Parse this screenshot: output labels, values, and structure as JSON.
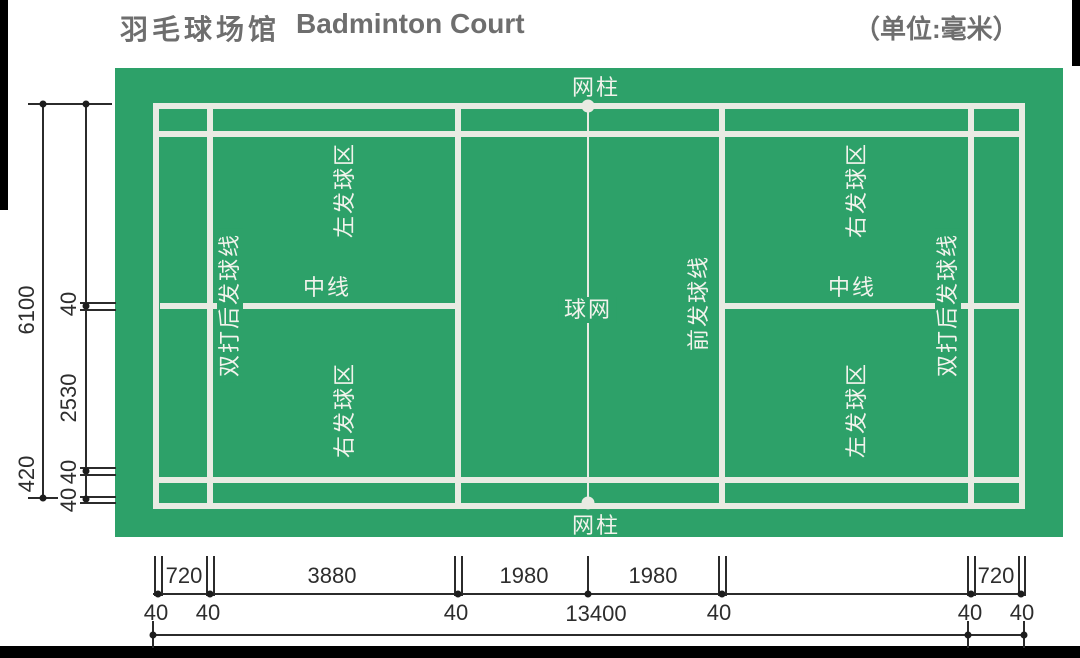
{
  "title": {
    "zh": "羽毛球场馆",
    "en": "Badminton Court",
    "unit": "（单位:毫米）"
  },
  "colors": {
    "court_green": "#2da169",
    "court_line_white": "#e9ebe3",
    "court_label_text": "#f2f3ec",
    "dimension_line": "#2b2b2b",
    "dimension_text": "#2d2d2d",
    "title_text": "#6e6e6e",
    "frame_black": "#000000"
  },
  "court_labels": {
    "net_post": "网柱",
    "net": "球网",
    "short_service_line": "前发球线",
    "center_line": "中线",
    "left_service_area": "左发球区",
    "right_service_area": "右发球区",
    "doubles_long_service_line": "双打后发球线"
  },
  "dimensions": {
    "height_total": "6100",
    "line_width": "40",
    "service_court_depth": "2530",
    "side_alley": "420",
    "back_alley": "720",
    "long_service_span": "3880",
    "net_to_short_service": "1980",
    "length_total": "13400"
  }
}
